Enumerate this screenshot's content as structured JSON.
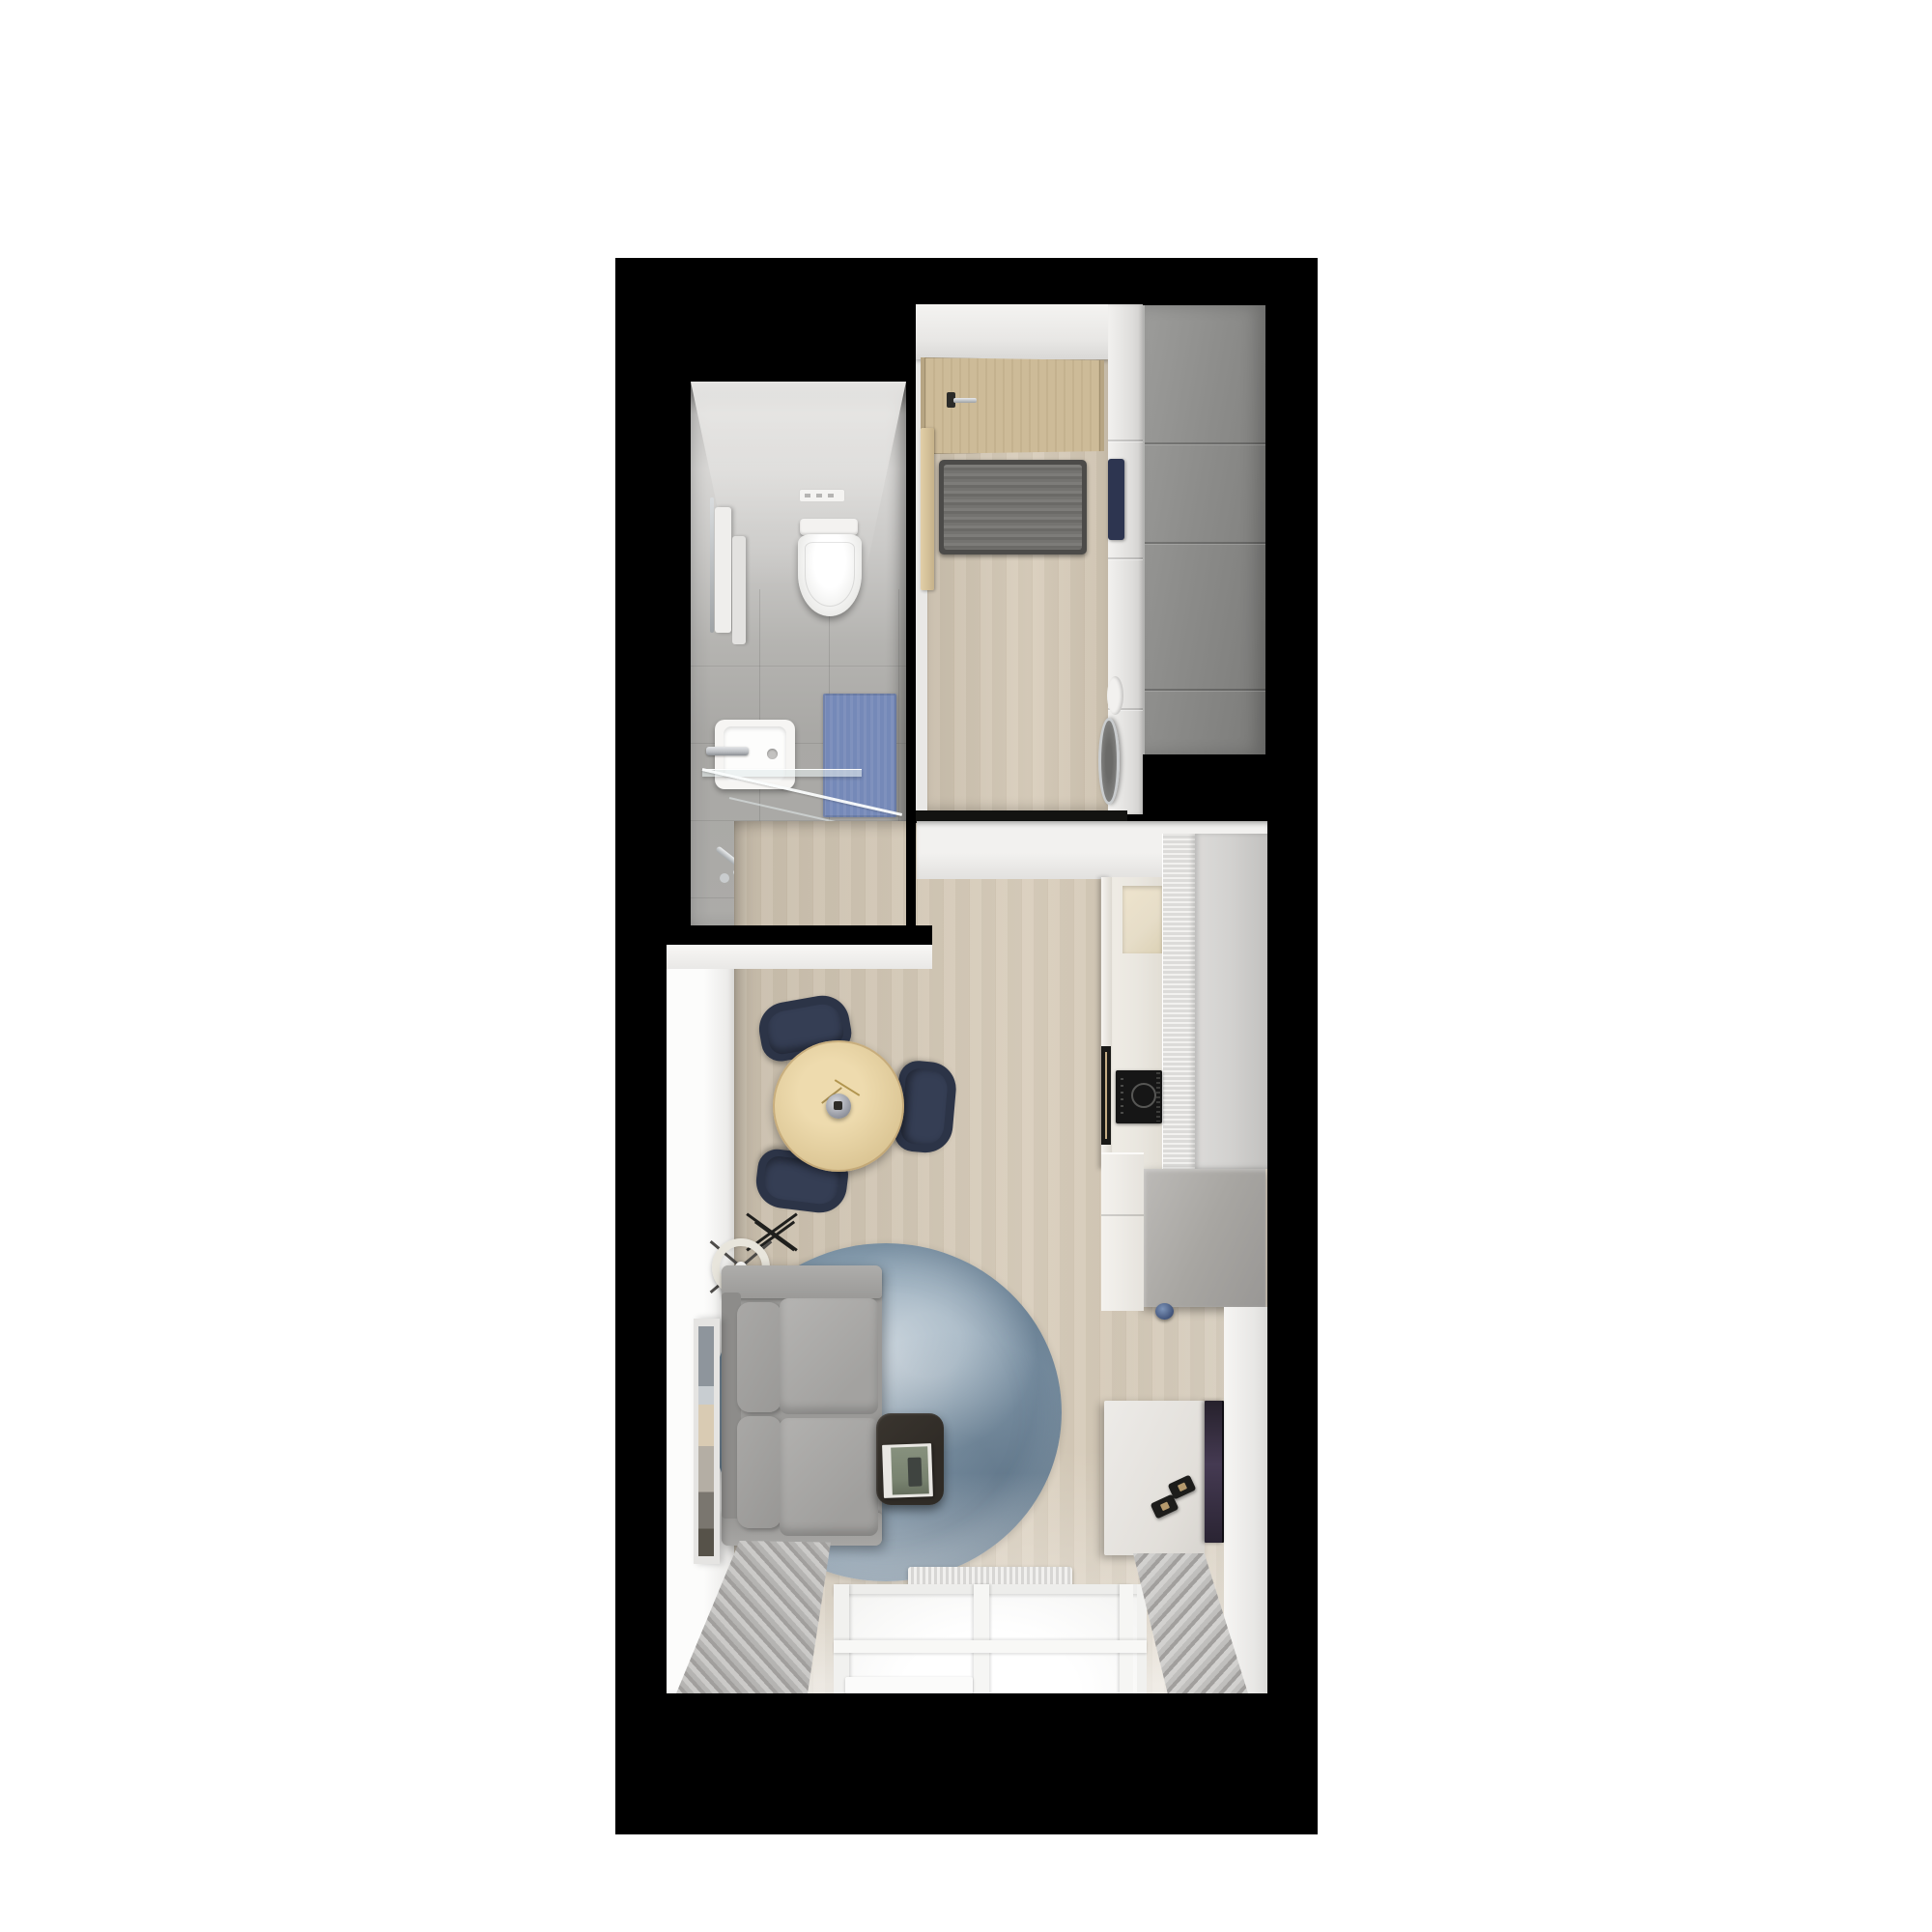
{
  "scene": {
    "title": "Studio apartment 3D floor plan (top-down render)",
    "view": "top-down",
    "rooms": [
      {
        "name": "bathroom",
        "position": "top-left",
        "fixtures": [
          "ceiling-vent",
          "wall-hung-toilet",
          "hanging-towels",
          "towel-rail",
          "washbasin",
          "basin-faucet",
          "glass-shelf",
          "shower-area",
          "shower-glass-screen",
          "shower-set",
          "blue-bath-mat"
        ]
      },
      {
        "name": "entry-hall",
        "position": "top-right",
        "fixtures": [
          "entrance-door",
          "door-handle",
          "door-jamb",
          "striped-doormat",
          "closet-front",
          "navy-bench-cushion",
          "washing-machine",
          "gray-wardrobe"
        ]
      },
      {
        "name": "kitchen",
        "position": "middle-right",
        "fixtures": [
          "tall-gray-panel",
          "fluted-cabinet",
          "counter",
          "counter-niche",
          "induction-cooktop",
          "cabinet-handle-strip",
          "peninsula",
          "blue-kettle"
        ]
      },
      {
        "name": "living-room",
        "position": "bottom",
        "fixtures": [
          "round-dining-table",
          "vase-with-sprigs",
          "three-navy-chairs",
          "ring-floor-lamp",
          "black-decor-stand",
          "gray-sofa",
          "round-blue-rug",
          "dark-side-table",
          "magazine",
          "leaning-artwork",
          "tv-console",
          "two-speakers",
          "wall-tv",
          "radiator",
          "window",
          "window-sill",
          "left-curtain",
          "right-curtain"
        ]
      }
    ]
  },
  "palette": {
    "page-bg": "#ffffff",
    "wall-black": "#000000",
    "wall-white": "#f2f1ef",
    "wood": "#d6cab7",
    "door-wood": "#cdbb98",
    "door-frame": "#b7a583",
    "mat-dark": "#4c4b49",
    "wardrobe-gray": "#8c8c8a",
    "kitchen-wall": "#d2d1cf",
    "counter-cream": "#eae7e0",
    "niche-beige": "#e6ddc8",
    "cooktop-black": "#161616",
    "peninsula-gray": "#a8a6a2",
    "bath-floor": "#a9a8a5",
    "bath-mat-blue": "#7589b8",
    "fixture-white": "#f4f3f1",
    "chrome": "#b9bcc0",
    "table-wood": "#e0cb9b",
    "chair-navy": "#2c3447",
    "navy-cushion": "#2d3550",
    "sofa-gray": "#9a9997",
    "sofa-cushion": "#a9a8a6",
    "rug-blue": "#8fa5b6",
    "rug-light": "#b6c4cf",
    "rug-dark": "#778da0",
    "side-table-brown": "#2f2b26",
    "magazine-green": "#78826f",
    "lamp-cream": "#e8e5dc",
    "tv-dark": "#26212c",
    "tv-purple": "#453a52",
    "console-white": "#edebe8",
    "curtain-gray": "#b5b4b2",
    "curtain-dark": "#a19f9d",
    "curtain-light": "#cbcac8",
    "art-blue": "#8e959c"
  }
}
